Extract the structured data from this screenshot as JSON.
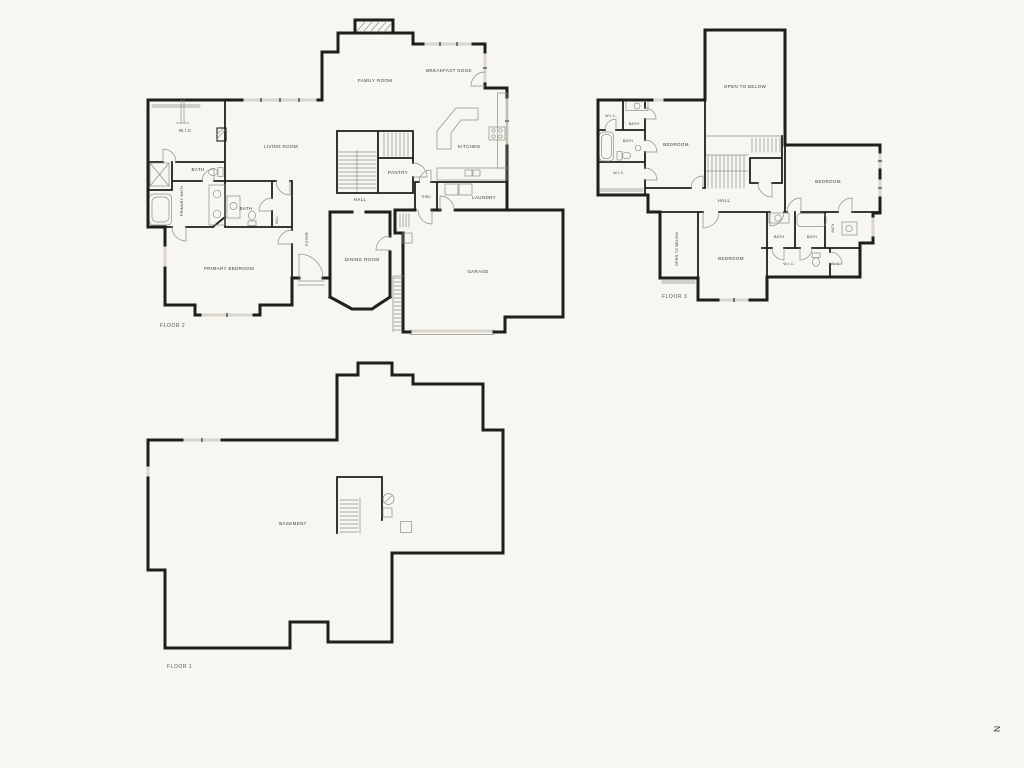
{
  "colors": {
    "background": "#f7f6f0",
    "wall": "#1f1e1c",
    "label": "#3d3d38",
    "window": "#d8d7ce",
    "thin": "#8f8f87"
  },
  "floor2": {
    "label": "FLOOR 2",
    "rooms": {
      "wic": "W.I.C.",
      "bath_upper": "BATH",
      "living": "LIVING ROOM",
      "family": "FAMILY ROOM",
      "breakfast": "BREAKFAST NOOK",
      "kitchen": "KITCHEN",
      "primary_bath": "PRIMARY BATH",
      "bath_lower": "BATH",
      "hall_closet": "HALL",
      "pantry": "PANTRY",
      "hall": "HALL",
      "thru": "THRU",
      "laundry": "LAUNDRY",
      "foyer": "FOYER",
      "primary_bedroom": "PRIMARY BEDROOM",
      "dining": "DINING ROOM",
      "garage": "GARAGE"
    }
  },
  "floor3": {
    "label": "FLOOR 3",
    "rooms": {
      "open_below_main": "OPEN TO BELOW",
      "wic_nw": "W.I.C.",
      "bath_nw": "BATH",
      "bath_w": "BATH",
      "wic_w": "W.I.C.",
      "bedroom_w": "BEDROOM",
      "hall": "HALL",
      "bedroom_e": "BEDROOM",
      "open_below_strip": "OPEN TO BELOW",
      "bedroom_s": "BEDROOM",
      "bath_s1": "BATH",
      "bath_s2": "BATH",
      "bath_s3": "BATH",
      "wic_s1": "W.I.C.",
      "wic_s2": "W.I.C."
    }
  },
  "floor1": {
    "label": "FLOOR 1",
    "rooms": {
      "basement": "BASEMENT"
    }
  },
  "compass": {
    "north": "N"
  }
}
